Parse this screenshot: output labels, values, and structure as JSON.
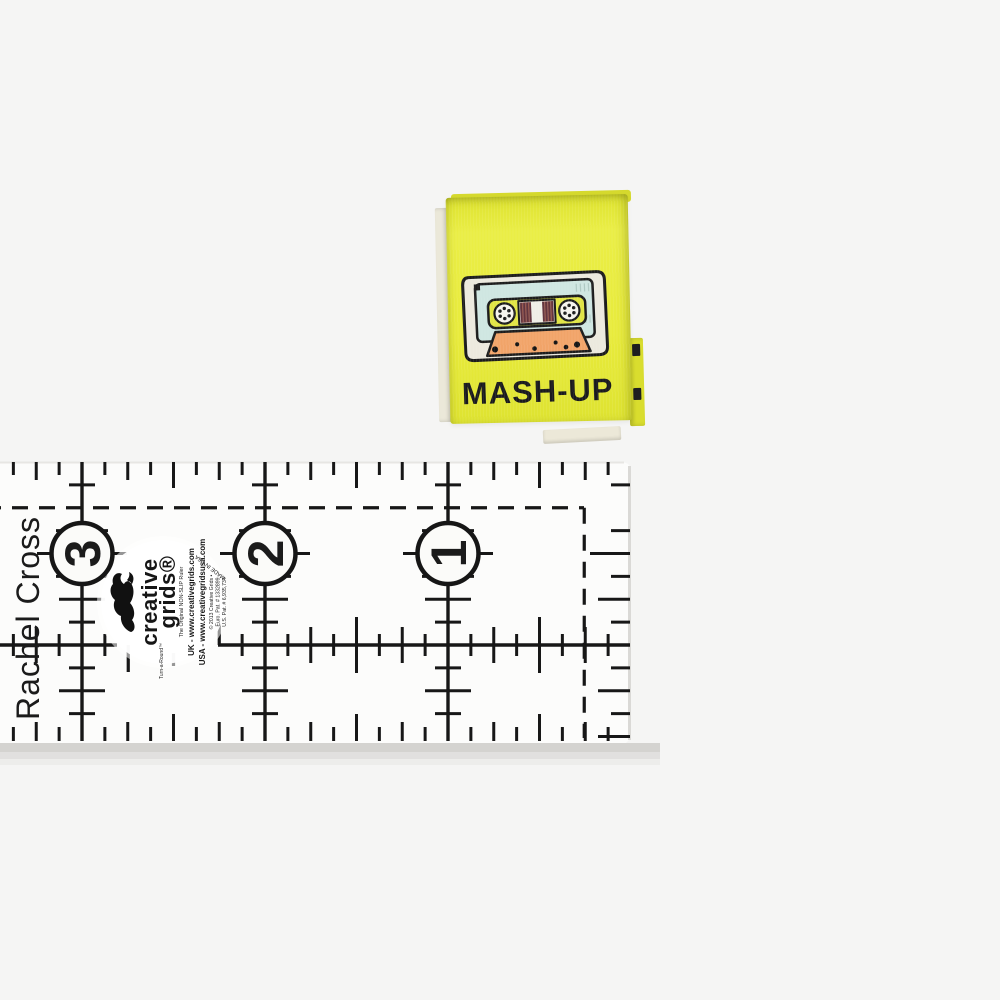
{
  "photo": {
    "background_color": "#f5f5f4"
  },
  "label": {
    "text": "MASH-UP",
    "background_color": "#e7ea3a",
    "text_color": "#1a1a1d",
    "icon": "cassette-tape-icon",
    "cassette": {
      "body_color": "#ece9de",
      "window_color": "#cfe6e1",
      "band_color": "#e1e545",
      "tape_color": "#63353e",
      "base_color": "#f1a469"
    }
  },
  "ruler": {
    "marking_color": "#171717",
    "circles": [
      {
        "label": "3"
      },
      {
        "label": "2"
      },
      {
        "label": "1"
      }
    ],
    "brand": {
      "logo_icon": "squirrel-icon",
      "turnaround": "Turn-a-Round™",
      "name_line1": "creative",
      "name_line2": "grids®",
      "subtitle": "The Original NON-SLIP Ruler",
      "uk_line": "UK - www.creativegrids.com",
      "usa_line": "USA - www.creativegridsusa.com",
      "copyright_line": "© 2013 Creative Grids •",
      "euro_patent": "Euro. Pat. # 1332899",
      "us_patent": "U.S. Pat. # 6,935,734",
      "made_in": "MADE IN USA"
    }
  },
  "watermark": {
    "credit": "Rachel Cross"
  }
}
